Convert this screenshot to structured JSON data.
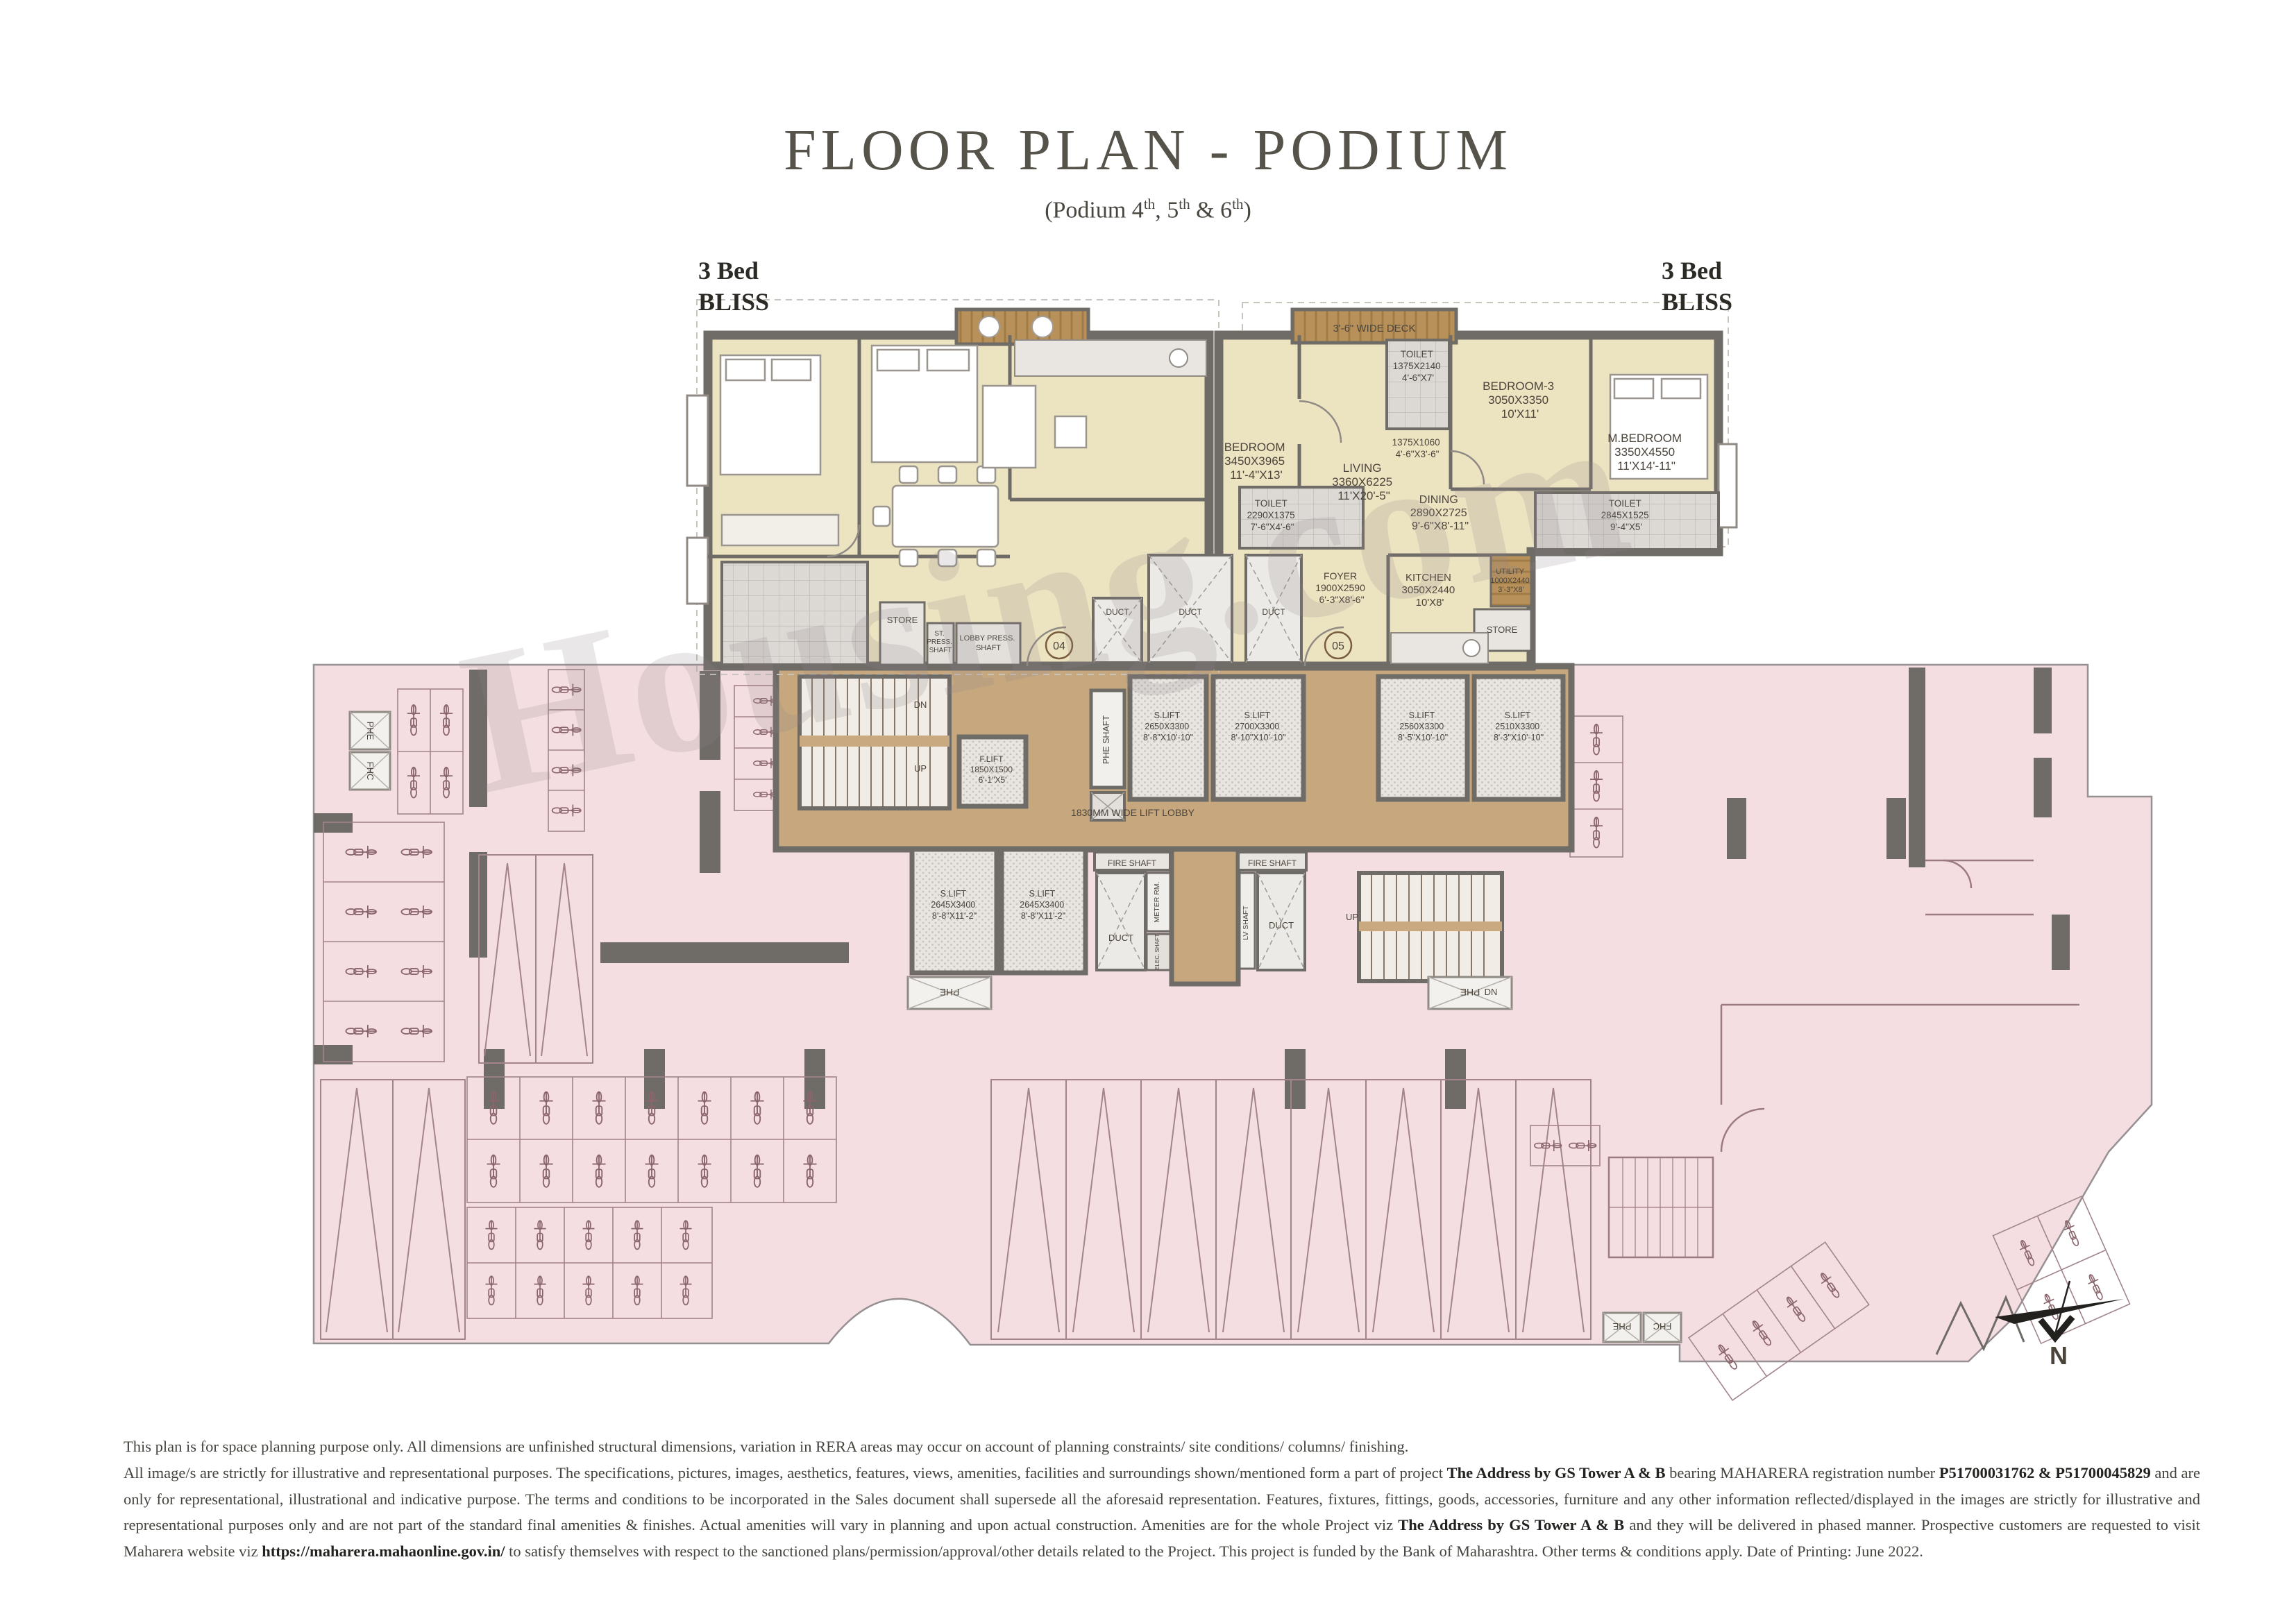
{
  "header": {
    "title": "FLOOR PLAN - PODIUM",
    "subtitle": {
      "p1": "(Podium 4",
      "sup1": "th",
      "p2": ", 5",
      "sup2": "th",
      "p3": " & 6",
      "sup3": "th",
      "p4": ")"
    }
  },
  "units": {
    "left": {
      "line1": "3 Bed",
      "line2": "BLISS"
    },
    "right": {
      "line1": "3 Bed",
      "line2": "BLISS"
    }
  },
  "rooms": {
    "bedroom": {
      "name": "BEDROOM",
      "mm": "3450X3965",
      "ft": "11'-4\"X13'"
    },
    "living": {
      "name": "LIVING",
      "mm": "3360X6225",
      "ft": "11'X20'-5\""
    },
    "toilet_common": {
      "name": "TOILET",
      "mm": "2290X1375",
      "ft": "7'-6\"X4'-6\""
    },
    "passage": {
      "mm": "1375X1060",
      "ft": "4'-6\"X3'-6\""
    },
    "toilet_bed3": {
      "name": "TOILET",
      "mm": "1375X2140",
      "ft": "4'-6\"X7'"
    },
    "bedroom3": {
      "name": "BEDROOM-3",
      "mm": "3050X3350",
      "ft": "10'X11'"
    },
    "master_bedroom": {
      "name": "M.BEDROOM",
      "mm": "3350X4550",
      "ft": "11'X14'-11\""
    },
    "toilet_master": {
      "name": "TOILET",
      "mm": "2845X1525",
      "ft": "9'-4\"X5'"
    },
    "dining": {
      "name": "DINING",
      "mm": "2890X2725",
      "ft": "9'-6\"X8'-11\""
    },
    "foyer": {
      "name": "FOYER",
      "mm": "1900X2590",
      "ft": "6'-3\"X8'-6\""
    },
    "kitchen": {
      "name": "KITCHEN",
      "mm": "3050X2440",
      "ft": "10'X8'"
    },
    "utility": {
      "name": "UTILITY",
      "mm": "1000X2440",
      "ft": "3'-3\"X8'"
    },
    "store": "STORE",
    "deck": "3'-6\" WIDE DECK",
    "st_press_shaft": {
      "l1": "ST.",
      "l2": "PRESS.",
      "l3": "SHAFT"
    },
    "lobby_press_shaft": {
      "l1": "LOBBY PRESS.",
      "l2": "SHAFT"
    },
    "unit_no_left": "04",
    "unit_no_right": "05"
  },
  "core": {
    "phe_shaft": "PHE SHAFT",
    "slift_a": {
      "name": "S.LIFT",
      "mm": "2650X3300",
      "ft": "8'-8\"X10'-10\""
    },
    "slift_b": {
      "name": "S.LIFT",
      "mm": "2700X3300",
      "ft": "8'-10\"X10'-10\""
    },
    "slift_c": {
      "name": "S.LIFT",
      "mm": "2560X3300",
      "ft": "8'-5\"X10'-10\""
    },
    "slift_d": {
      "name": "S.LIFT",
      "mm": "2510X3300",
      "ft": "8'-3\"X10'-10\""
    },
    "slift_e": {
      "name": "S.LIFT",
      "mm": "2645X3400",
      "ft": "8'-8\"X11'-2\""
    },
    "slift_f": {
      "name": "S.LIFT",
      "mm": "2645X3400",
      "ft": "8'-8\"X11'-2\""
    },
    "flift": {
      "name": "F.LIFT",
      "mm": "1850X1500",
      "ft": "6'-1\"X5'"
    },
    "lift_lobby": "1830MM WIDE LIFT LOBBY",
    "fire_shaft": "FIRE SHAFT",
    "meter_rm": "METER RM.",
    "elec_shaft": "ELEC. SHAFT",
    "lv_shaft": "LV SHAFT",
    "duct": "DUCT",
    "dn": "DN",
    "up": "UP",
    "phe": "PHE",
    "fhc": "FHC"
  },
  "compass": {
    "label": "N"
  },
  "watermark": "Housing.com",
  "disclaimer": {
    "line1": "This plan is for space planning purpose only. All dimensions are unfinished structural dimensions, variation in RERA areas may occur on account of planning constraints/ site conditions/ columns/ finishing.",
    "p2": {
      "s1": "All image/s are strictly for illustrative and representational purposes. The specifications, pictures, images, aesthetics, features, views, amenities, facilities and surroundings shown/mentioned form a part of project ",
      "b1": "The Address by GS Tower A & B",
      "s2": " bearing MAHARERA registration number ",
      "b2": "P51700031762 & P51700045829",
      "s3": " and are only for representational, illustrational and indicative purpose. The terms and conditions to be incorporated in the Sales document shall supersede all the aforesaid representation. Features, fixtures, fittings, goods, accessories, furniture and any other information reflected/displayed in the images are strictly for illustrative and representational purposes only and are not part of the standard final amenities & finishes. Actual amenities will vary in planning and upon actual construction. Amenities are for the whole Project viz ",
      "b3": "The Address by GS Tower A & B",
      "s4": " and they will be delivered in phased manner. Prospective customers are requested to visit Maharera website viz ",
      "b4": "https://maharera.mahaonline.gov.in/",
      "s5": " to satisfy themselves with respect to the sanctioned plans/permission/approval/other details related to the Project. This project is funded by the Bank of Maharashtra. Other terms & conditions apply. Date of Printing: June 2022."
    }
  }
}
